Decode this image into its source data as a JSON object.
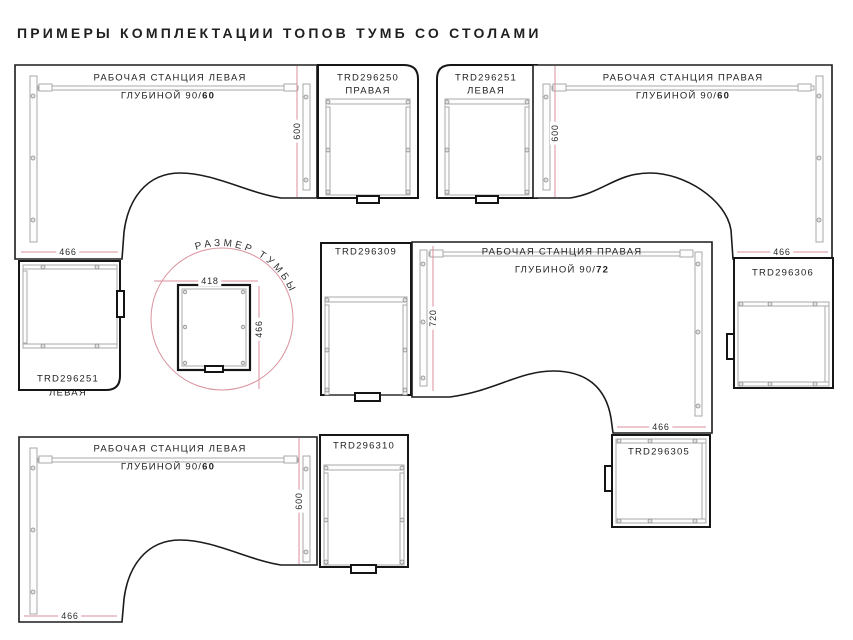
{
  "title": "ПРИМЕРЫ КОМПЛЕКТАЦИИ ТОПОВ ТУМБ СО СТОЛАМИ",
  "workstations": [
    {
      "name": "РАБОЧАЯ СТАНЦИЯ ЛЕВАЯ",
      "depth_prefix": "ГЛУБИНОЙ 90/",
      "depth_bold": "60",
      "width_dim": "466",
      "height_dim": "600"
    },
    {
      "name": "РАБОЧАЯ СТАНЦИЯ ПРАВАЯ",
      "depth_prefix": "ГЛУБИНОЙ 90/",
      "depth_bold": "60",
      "width_dim": "466",
      "height_dim": "600"
    },
    {
      "name": "РАБОЧАЯ СТАНЦИЯ ПРАВАЯ",
      "depth_prefix": "ГЛУБИНОЙ 90/",
      "depth_bold": "72",
      "width_dim": "466",
      "height_dim": "720"
    },
    {
      "name": "РАБОЧАЯ СТАНЦИЯ ЛЕВАЯ",
      "depth_prefix": "ГЛУБИНОЙ 90/",
      "depth_bold": "60",
      "width_dim": "466",
      "height_dim": "600"
    }
  ],
  "cabinets": {
    "trd296250": {
      "code": "TRD296250",
      "variant": "ПРАВАЯ"
    },
    "trd296251_top": {
      "code": "TRD296251",
      "variant": "ЛЕВАЯ"
    },
    "trd296251_side": {
      "code": "TRD296251",
      "variant": "ЛЕВАЯ"
    },
    "trd296309": {
      "code": "TRD296309"
    },
    "trd296306": {
      "code": "TRD296306"
    },
    "trd296305": {
      "code": "TRD296305"
    },
    "trd296310": {
      "code": "TRD296310"
    }
  },
  "size_callout": {
    "label": "РАЗМЕР ТУМБЫ",
    "width_dim": "418",
    "depth_dim": "466"
  },
  "colors": {
    "line": "#1b1b1b",
    "detail": "#a9a9a9",
    "dimension": "#d9929d"
  }
}
